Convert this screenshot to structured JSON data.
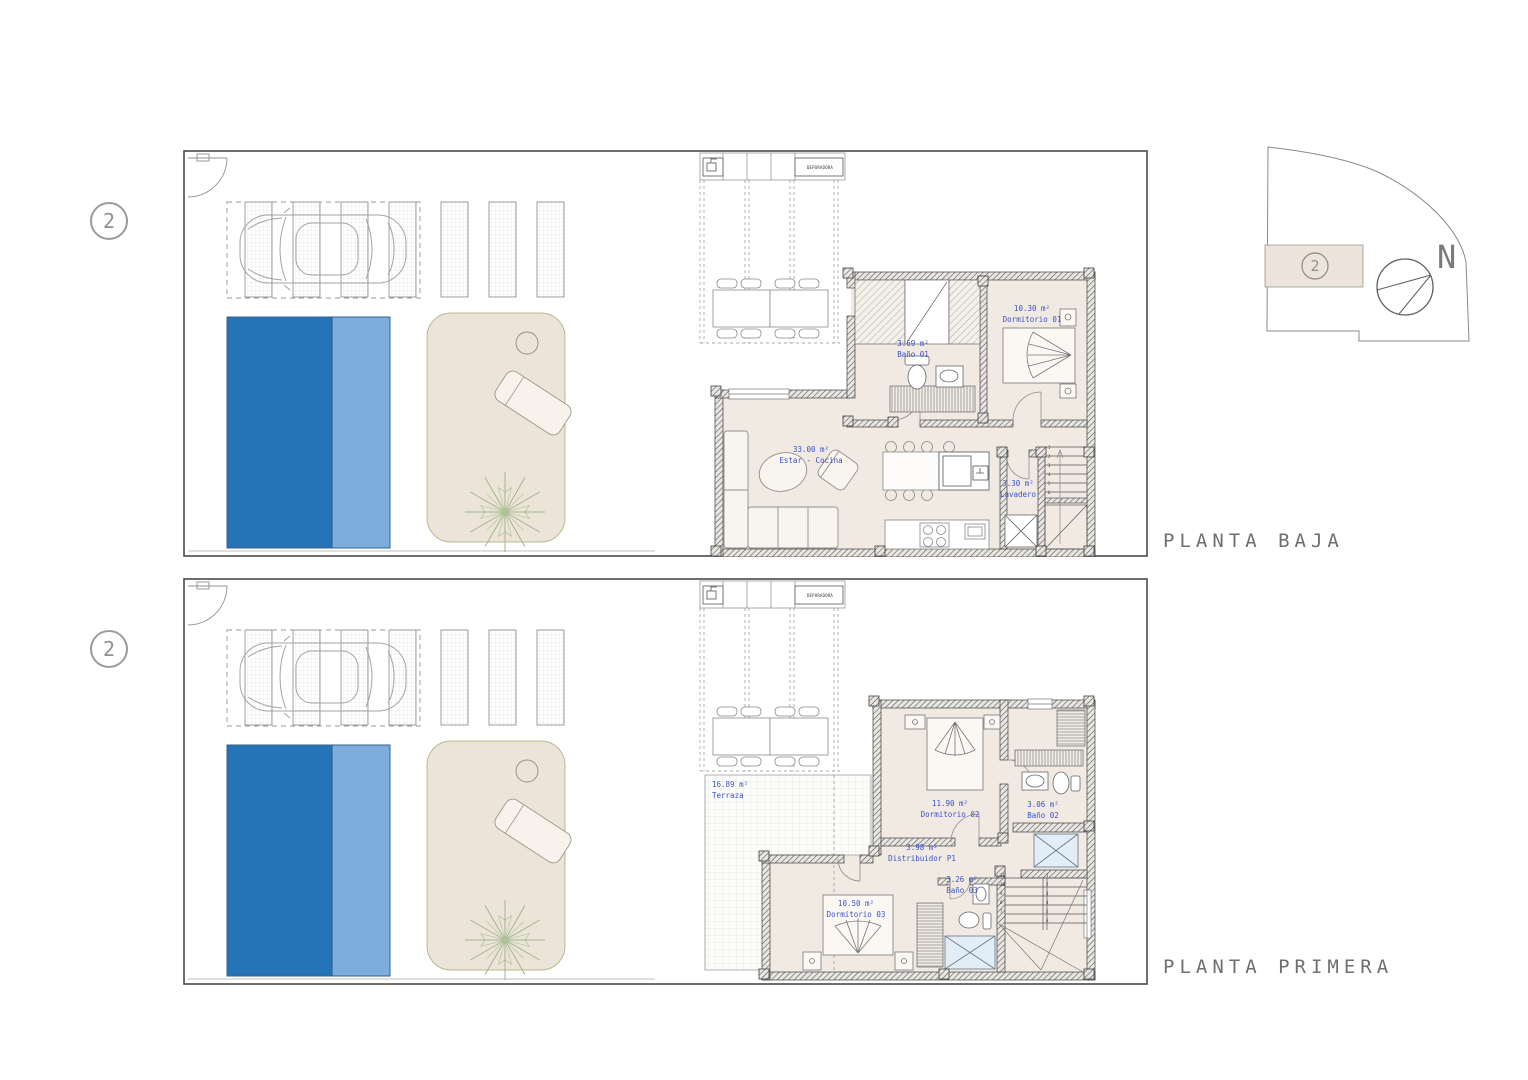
{
  "sheet": {
    "plans": [
      {
        "title": "PLANTA BAJA",
        "unit_number": "2",
        "equipment_label": "DEPURADORA",
        "rooms": [
          {
            "area": "33.00 m²",
            "name": "Estar - Cocina"
          },
          {
            "area": "10.30 m²",
            "name": "Dormitorio 01"
          },
          {
            "area": "3.69 m²",
            "name": "Baño 01"
          },
          {
            "area": "3.30 m²",
            "name": "Lavadero"
          }
        ],
        "stair_steps": [
          "1",
          "2",
          "3",
          "4",
          "5",
          "6"
        ]
      },
      {
        "title": "PLANTA PRIMERA",
        "unit_number": "2",
        "equipment_label": "DEPURADORA",
        "rooms": [
          {
            "area": "16.89 m²",
            "name": "Terraza"
          },
          {
            "area": "11.90 m²",
            "name": "Dormitorio 02"
          },
          {
            "area": "3.06 m²",
            "name": "Baño 02"
          },
          {
            "area": "3.98 m²",
            "name": "Distribuidor P1"
          },
          {
            "area": "3.26 m²",
            "name": "Baño 03"
          },
          {
            "area": "10.50 m²",
            "name": "Dormitorio 03"
          }
        ],
        "stair_steps_flight1": [
          "1",
          "2",
          "3",
          "4",
          "5",
          "6"
        ],
        "stair_steps_flight2": [
          "11",
          "10",
          "9",
          "8",
          "7"
        ]
      }
    ],
    "key_plan": {
      "unit_number": "2",
      "north_label": "N"
    },
    "colors": {
      "pool_dark": "#2674b8",
      "pool_light": "#7caddd",
      "patio_beige": "#ece4d9",
      "floor_beige": "#f1eae3",
      "label_blue": "#3c51c9",
      "shower_blue": "#e3edf6",
      "line_gray": "#4a4a4a",
      "tree_green": "#9fb789"
    }
  }
}
